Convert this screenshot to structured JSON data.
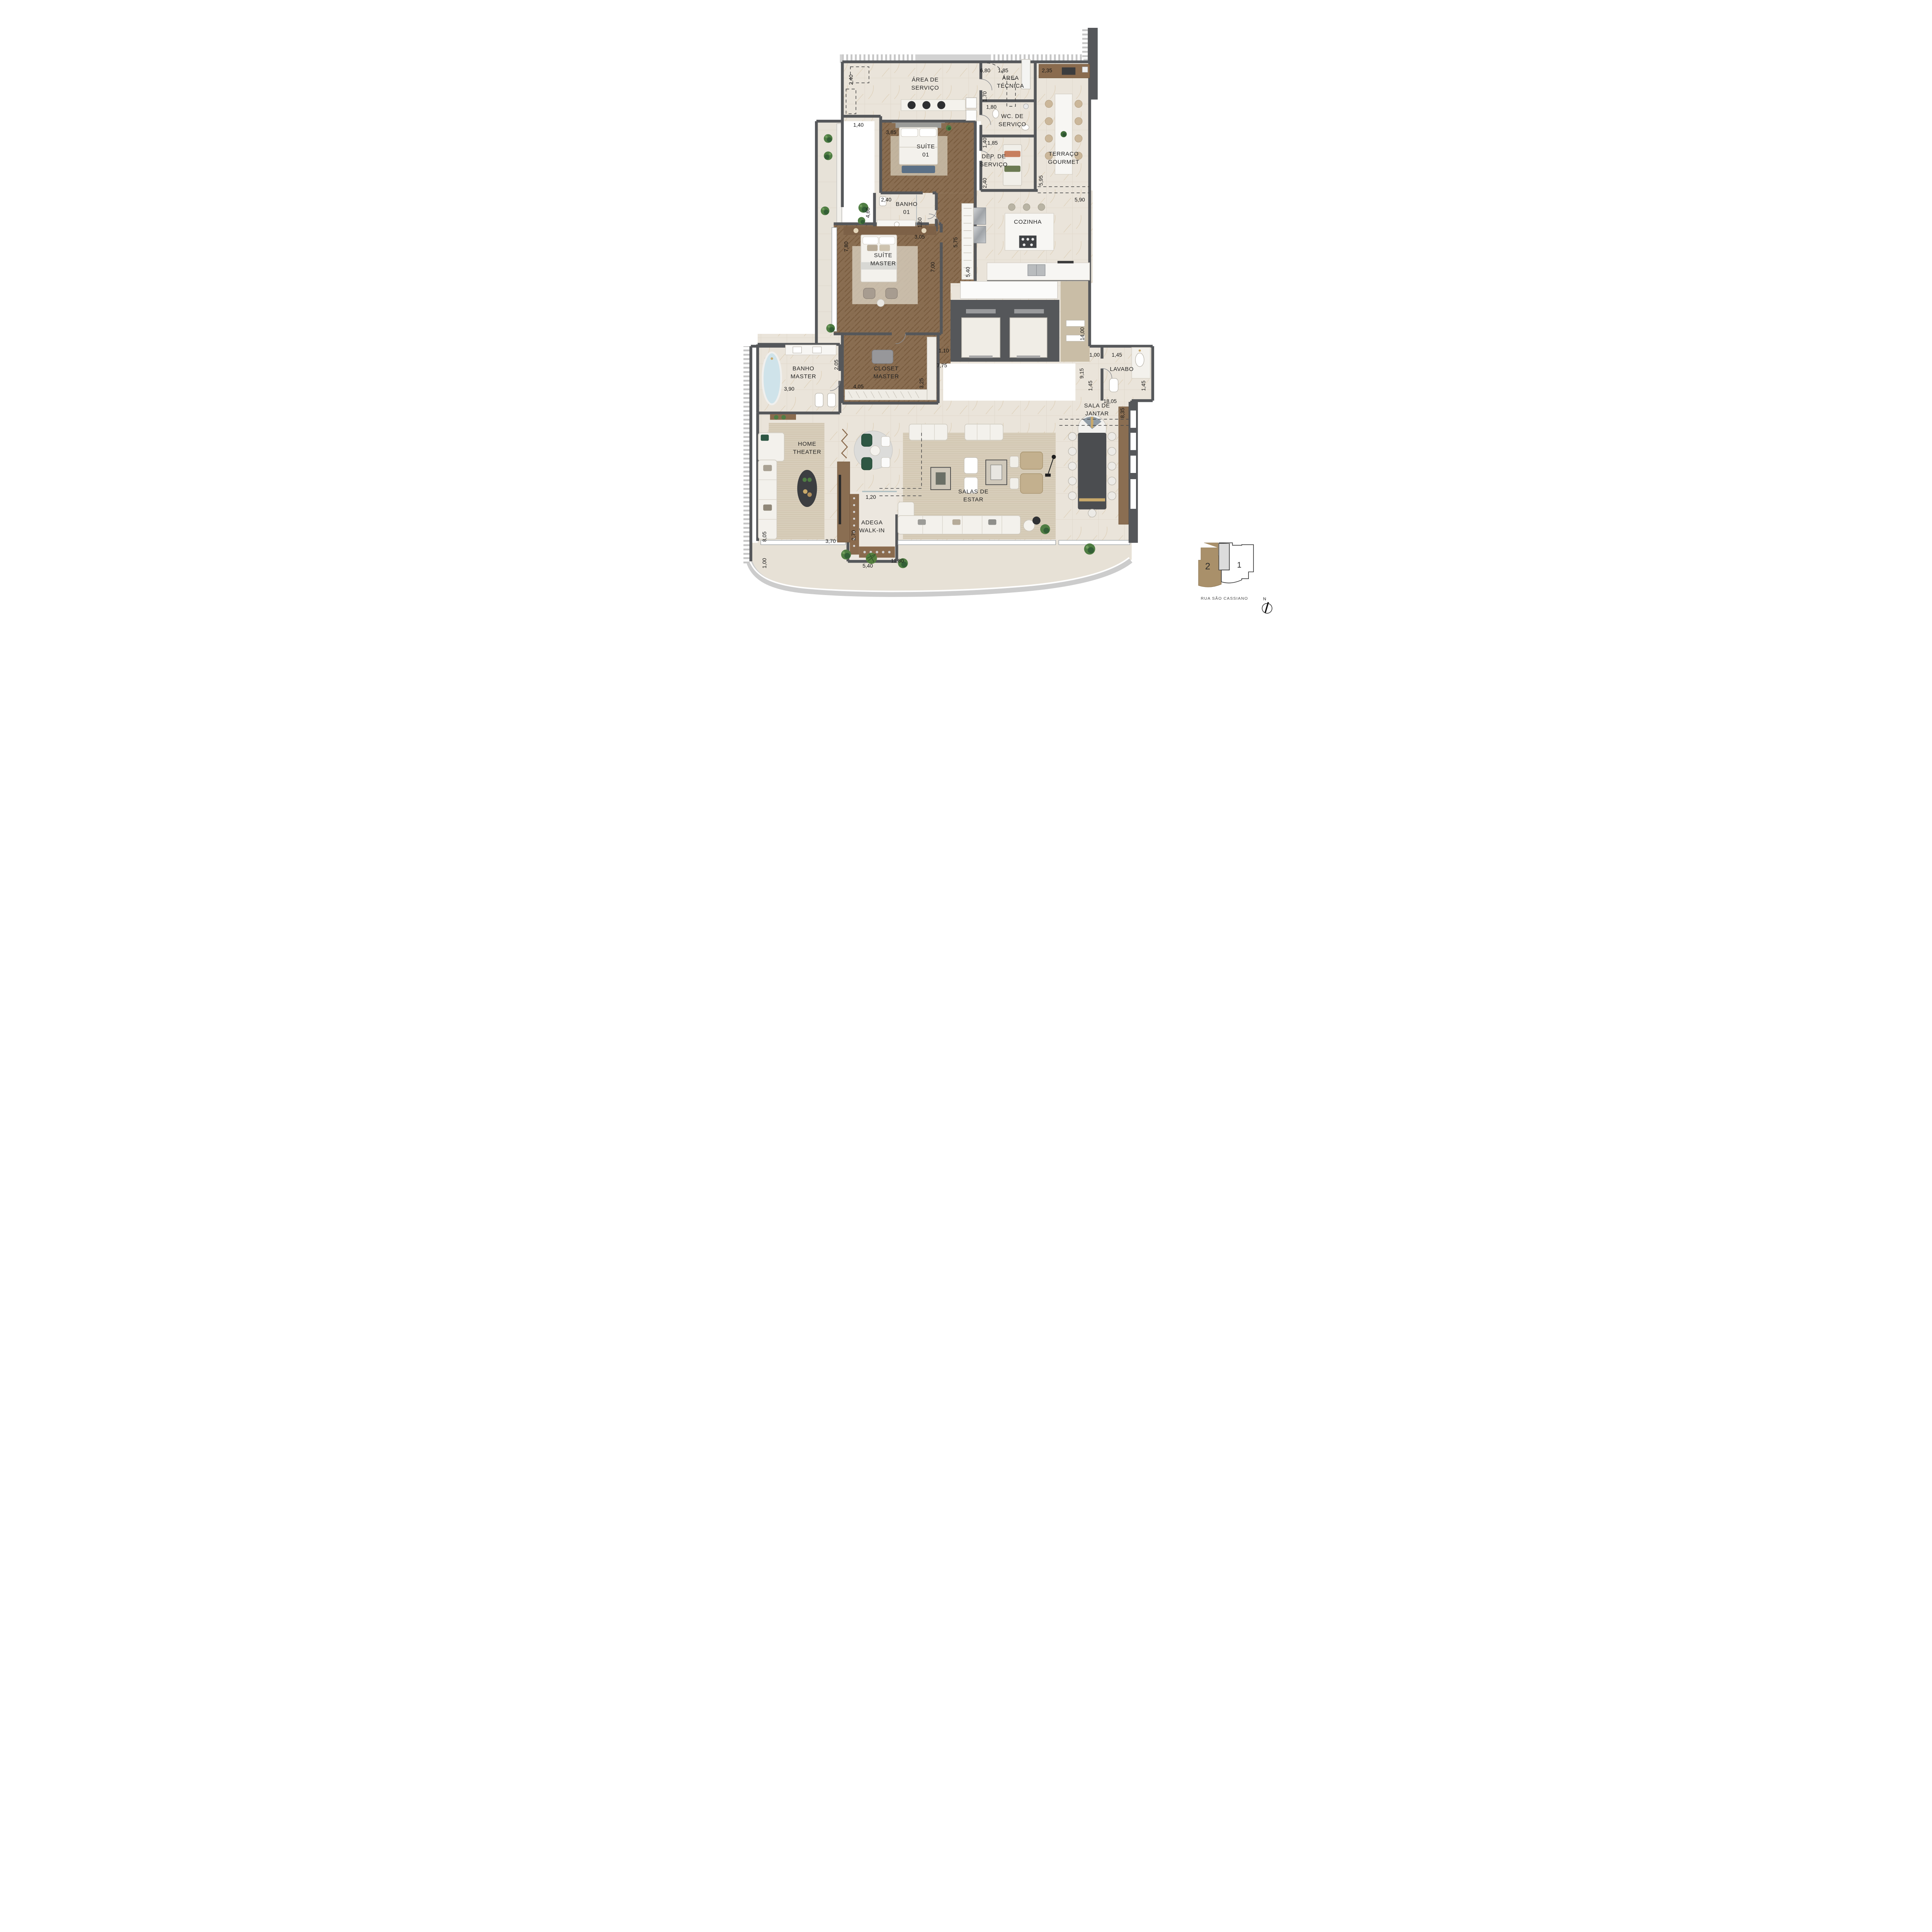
{
  "plan": {
    "rooms": {
      "area_servico": [
        "ÁREA DE",
        "SERVIÇO"
      ],
      "area_tecnica": [
        "ÁREA",
        "TÉCNICA"
      ],
      "wc_servico": [
        "WC. DE",
        "SERVIÇO"
      ],
      "dep_servico": [
        "DEP. DE",
        "SERVIÇO"
      ],
      "terraco_gourmet": [
        "TERRAÇO",
        "GOURMET"
      ],
      "suite01": [
        "SUÍTE",
        "01"
      ],
      "banho01": [
        "BANHO",
        "01"
      ],
      "cozinha": [
        "COZINHA"
      ],
      "suite_master": [
        "SUÍTE",
        "MASTER"
      ],
      "closet_master": [
        "CLOSET",
        "MASTER"
      ],
      "banho_master": [
        "BANHO",
        "MASTER"
      ],
      "lavabo": [
        "LAVABO"
      ],
      "sala_jantar": [
        "SALA DE",
        "JANTAR"
      ],
      "home_theater": [
        "HOME",
        "THEATER"
      ],
      "adega": [
        "ADEGA",
        "WALK-IN"
      ],
      "salas_estar": [
        "SALAS DE",
        "ESTAR"
      ]
    },
    "dims": {
      "d_servico_w": "2,40",
      "d_top1": "6,80",
      "d_top2": "1,85",
      "d_top3": "2,35",
      "d_tec_h": "1,70",
      "d_wc_w": "1,80",
      "d_wc_h": "1,40",
      "d_dep_w": "1,85",
      "d_dep_h": "2,40",
      "d_ter_h": "5,95",
      "d_ter_w": "5,90",
      "d_s1_niche": "1,40",
      "d_s1_w": "3,85",
      "d_b1_w": "2,40",
      "d_b1_h": "1,60",
      "d_hall_w": "3,05",
      "d_ward": "5,75",
      "d_niche2": "4,60",
      "d_sm_h": "7,80",
      "d_sm_w": "7,00",
      "d_coz": "5,40",
      "d_corr1": "1,10",
      "d_corr2": "7,75",
      "d_bm_a": "2,05",
      "d_bm_w": "3,90",
      "d_cl_w": "4,05",
      "d_cl_h": "3,25",
      "d_e_1400": "14,00",
      "d_e_915": "9,15",
      "d_hall100": "1,00",
      "d_lav_w": "1,45",
      "d_h145": "1,45",
      "d_lav_h": "1,45",
      "d_jt_1805": "18,05",
      "d_jt_835": "8,35",
      "d_ad_120": "1,20",
      "d_ht_805": "8,05",
      "d_ht_100": "1,00",
      "d_ht_370": "3,70",
      "d_ad_270": "2,70",
      "d_bt_540": "5,40",
      "d_es_1180": "11,80"
    }
  },
  "keyplan": {
    "unit_highlighted": "2",
    "unit_other": "1",
    "street": "RUA SÃO CASSIANO",
    "compass": "N"
  },
  "colors": {
    "wall": "#55575a",
    "wood": "#8a6e52",
    "marble": "#eae4da",
    "tan": "#c9bda6",
    "plant_green": "#4f7d43",
    "keyplan_unit": "#a9906a",
    "gold": "#c9a96a",
    "tub_blue": "#cfe3ea"
  }
}
